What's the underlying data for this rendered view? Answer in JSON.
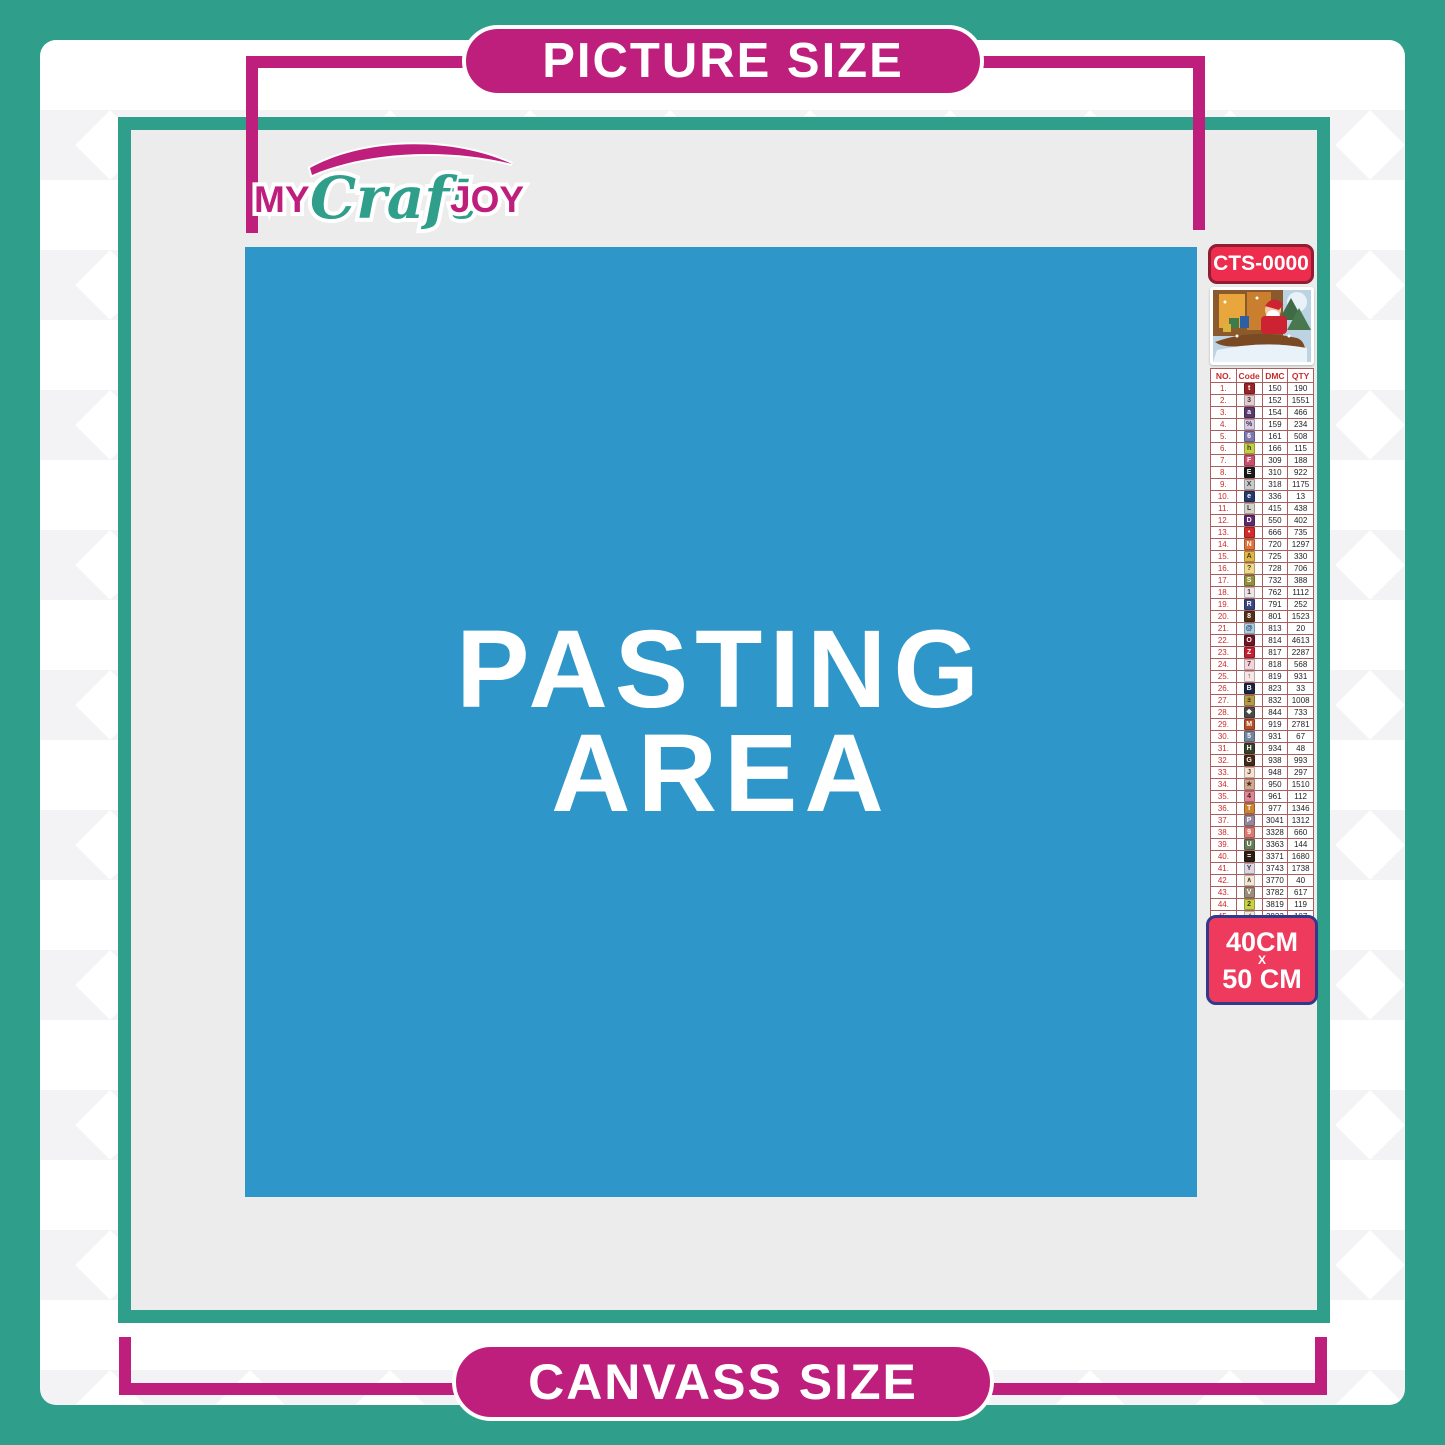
{
  "labels": {
    "picture_size": "PICTURE SIZE",
    "canvass_size": "CANVASS SIZE"
  },
  "logo": {
    "word1": "MY",
    "word2": "Craft",
    "word3": "JOY"
  },
  "pasting_area": {
    "line1": "PASTING",
    "line2": "AREA"
  },
  "sidebar": {
    "kit_code": "CTS-0000",
    "thumbnail": "christmas-santa-sleigh-scene",
    "size_badge": {
      "line1": "40CM",
      "line2": "X",
      "line3": "50 CM"
    },
    "table": {
      "headers": [
        "NO.",
        "Code",
        "DMC",
        "QTY"
      ],
      "rows": [
        {
          "no": "1.",
          "symbol": "t",
          "box": "#9b2226",
          "sym_color": "#ffffff",
          "dmc": "150",
          "qty": "190"
        },
        {
          "no": "2.",
          "symbol": "3",
          "box": "#e3cdd1",
          "sym_color": "#4a2a2a",
          "dmc": "152",
          "qty": "1551"
        },
        {
          "no": "3.",
          "symbol": "a",
          "box": "#5a3a6e",
          "sym_color": "#ffffff",
          "dmc": "154",
          "qty": "466"
        },
        {
          "no": "4.",
          "symbol": "%",
          "box": "#d5cbe0",
          "sym_color": "#4a2a4a",
          "dmc": "159",
          "qty": "234"
        },
        {
          "no": "5.",
          "symbol": "6",
          "box": "#8078b0",
          "sym_color": "#ffffff",
          "dmc": "161",
          "qty": "508"
        },
        {
          "no": "6.",
          "symbol": "h",
          "box": "#c3cf45",
          "sym_color": "#3a3a1a",
          "dmc": "166",
          "qty": "115"
        },
        {
          "no": "7.",
          "symbol": "F",
          "box": "#c94f6d",
          "sym_color": "#ffffff",
          "dmc": "309",
          "qty": "188"
        },
        {
          "no": "8.",
          "symbol": "E",
          "box": "#1a1a1a",
          "sym_color": "#ffffff",
          "dmc": "310",
          "qty": "922"
        },
        {
          "no": "9.",
          "symbol": "X",
          "box": "#c9c9c9",
          "sym_color": "#3a3a3a",
          "dmc": "318",
          "qty": "1175"
        },
        {
          "no": "10.",
          "symbol": "e",
          "box": "#253a6b",
          "sym_color": "#ffffff",
          "dmc": "336",
          "qty": "13"
        },
        {
          "no": "11.",
          "symbol": "L",
          "box": "#d6d1c8",
          "sym_color": "#3a3a3a",
          "dmc": "415",
          "qty": "438"
        },
        {
          "no": "12.",
          "symbol": "D",
          "box": "#5c2b6e",
          "sym_color": "#ffffff",
          "dmc": "550",
          "qty": "402"
        },
        {
          "no": "13.",
          "symbol": "•",
          "box": "#d22b2b",
          "sym_color": "#ffffff",
          "dmc": "666",
          "qty": "735"
        },
        {
          "no": "14.",
          "symbol": "N",
          "box": "#e2703a",
          "sym_color": "#ffffff",
          "dmc": "720",
          "qty": "1297"
        },
        {
          "no": "15.",
          "symbol": "A",
          "box": "#dfb545",
          "sym_color": "#4a3a1a",
          "dmc": "725",
          "qty": "330"
        },
        {
          "no": "16.",
          "symbol": "?",
          "box": "#efd989",
          "sym_color": "#4a3a1a",
          "dmc": "728",
          "qty": "706"
        },
        {
          "no": "17.",
          "symbol": "S",
          "box": "#948f3e",
          "sym_color": "#ffffff",
          "dmc": "732",
          "qty": "388"
        },
        {
          "no": "18.",
          "symbol": "1",
          "box": "#efe3e3",
          "sym_color": "#3a3a3a",
          "dmc": "762",
          "qty": "1112"
        },
        {
          "no": "19.",
          "symbol": "R",
          "box": "#39457f",
          "sym_color": "#ffffff",
          "dmc": "791",
          "qty": "252"
        },
        {
          "no": "20.",
          "symbol": "8",
          "box": "#54301a",
          "sym_color": "#ffffff",
          "dmc": "801",
          "qty": "1523"
        },
        {
          "no": "21.",
          "symbol": "@",
          "box": "#a9cde4",
          "sym_color": "#2a3a4a",
          "dmc": "813",
          "qty": "20"
        },
        {
          "no": "22.",
          "symbol": "O",
          "box": "#6e1623",
          "sym_color": "#ffffff",
          "dmc": "814",
          "qty": "4613"
        },
        {
          "no": "23.",
          "symbol": "Z",
          "box": "#c22133",
          "sym_color": "#ffffff",
          "dmc": "817",
          "qty": "2287"
        },
        {
          "no": "24.",
          "symbol": "7",
          "box": "#f4d3da",
          "sym_color": "#4a2a2a",
          "dmc": "818",
          "qty": "568"
        },
        {
          "no": "25.",
          "symbol": "↑",
          "box": "#f7e6e6",
          "sym_color": "#4a2a2a",
          "dmc": "819",
          "qty": "931"
        },
        {
          "no": "26.",
          "symbol": "B",
          "box": "#1b2440",
          "sym_color": "#ffffff",
          "dmc": "823",
          "qty": "33"
        },
        {
          "no": "27.",
          "symbol": "±",
          "box": "#b59b4c",
          "sym_color": "#3a2a0a",
          "dmc": "832",
          "qty": "1008"
        },
        {
          "no": "28.",
          "symbol": "❖",
          "box": "#4a4a4a",
          "sym_color": "#ffffff",
          "dmc": "844",
          "qty": "733"
        },
        {
          "no": "29.",
          "symbol": "M",
          "box": "#b44e27",
          "sym_color": "#ffffff",
          "dmc": "919",
          "qty": "2781"
        },
        {
          "no": "30.",
          "symbol": "5",
          "box": "#70889e",
          "sym_color": "#ffffff",
          "dmc": "931",
          "qty": "67"
        },
        {
          "no": "31.",
          "symbol": "H",
          "box": "#37412a",
          "sym_color": "#ffffff",
          "dmc": "934",
          "qty": "48"
        },
        {
          "no": "32.",
          "symbol": "G",
          "box": "#42291a",
          "sym_color": "#ffffff",
          "dmc": "938",
          "qty": "993"
        },
        {
          "no": "33.",
          "symbol": "J",
          "box": "#f6e0d2",
          "sym_color": "#4a3a2a",
          "dmc": "948",
          "qty": "297"
        },
        {
          "no": "34.",
          "symbol": "★",
          "box": "#d3a890",
          "sym_color": "#4a2a1a",
          "dmc": "950",
          "qty": "1510"
        },
        {
          "no": "35.",
          "symbol": "4",
          "box": "#dd8795",
          "sym_color": "#4a1a2a",
          "dmc": "961",
          "qty": "112"
        },
        {
          "no": "36.",
          "symbol": "T",
          "box": "#cd8433",
          "sym_color": "#ffffff",
          "dmc": "977",
          "qty": "1346"
        },
        {
          "no": "37.",
          "symbol": "P",
          "box": "#96859a",
          "sym_color": "#ffffff",
          "dmc": "3041",
          "qty": "1312"
        },
        {
          "no": "38.",
          "symbol": "9",
          "box": "#db7a72",
          "sym_color": "#ffffff",
          "dmc": "3328",
          "qty": "660"
        },
        {
          "no": "39.",
          "symbol": "U",
          "box": "#667e58",
          "sym_color": "#ffffff",
          "dmc": "3363",
          "qty": "144"
        },
        {
          "no": "40.",
          "symbol": "=",
          "box": "#2b1d14",
          "sym_color": "#ffffff",
          "dmc": "3371",
          "qty": "1680"
        },
        {
          "no": "41.",
          "symbol": "Y",
          "box": "#dcd7e2",
          "sym_color": "#3a3a4a",
          "dmc": "3743",
          "qty": "1738"
        },
        {
          "no": "42.",
          "symbol": "∧",
          "box": "#f3e8d7",
          "sym_color": "#4a3a2a",
          "dmc": "3770",
          "qty": "40"
        },
        {
          "no": "43.",
          "symbol": "V",
          "box": "#9b8b78",
          "sym_color": "#ffffff",
          "dmc": "3782",
          "qty": "617"
        },
        {
          "no": "44.",
          "symbol": "2",
          "box": "#c6d048",
          "sym_color": "#3a3a0a",
          "dmc": "3819",
          "qty": "119"
        },
        {
          "no": "45.",
          "symbol": "✓",
          "box": "#f2ead0",
          "sym_color": "#4a4a2a",
          "dmc": "3823",
          "qty": "107"
        },
        {
          "no": "46.",
          "symbol": "C",
          "box": "#e0913f",
          "sym_color": "#ffffff",
          "dmc": "3853",
          "qty": "1332"
        },
        {
          "no": "47.",
          "symbol": "K",
          "box": "#a65d55",
          "sym_color": "#ffffff",
          "dmc": "3858",
          "qty": "2311"
        },
        {
          "no": "48.",
          "symbol": "A",
          "box": "#c9b49b",
          "sym_color": "#3a2a1a",
          "dmc": "3863",
          "qty": "1820"
        }
      ]
    }
  },
  "colors": {
    "teal_frame": "#2f9e8a",
    "magenta_accent": "#bf1f7c",
    "pasting_blue": "#2e96c9",
    "canvas_gray": "#ececec",
    "kit_badge_red": "#ee2d4e",
    "size_badge_pink": "#ee3a5c",
    "size_badge_border_navy": "#33398a",
    "table_border": "#a95f5f"
  }
}
